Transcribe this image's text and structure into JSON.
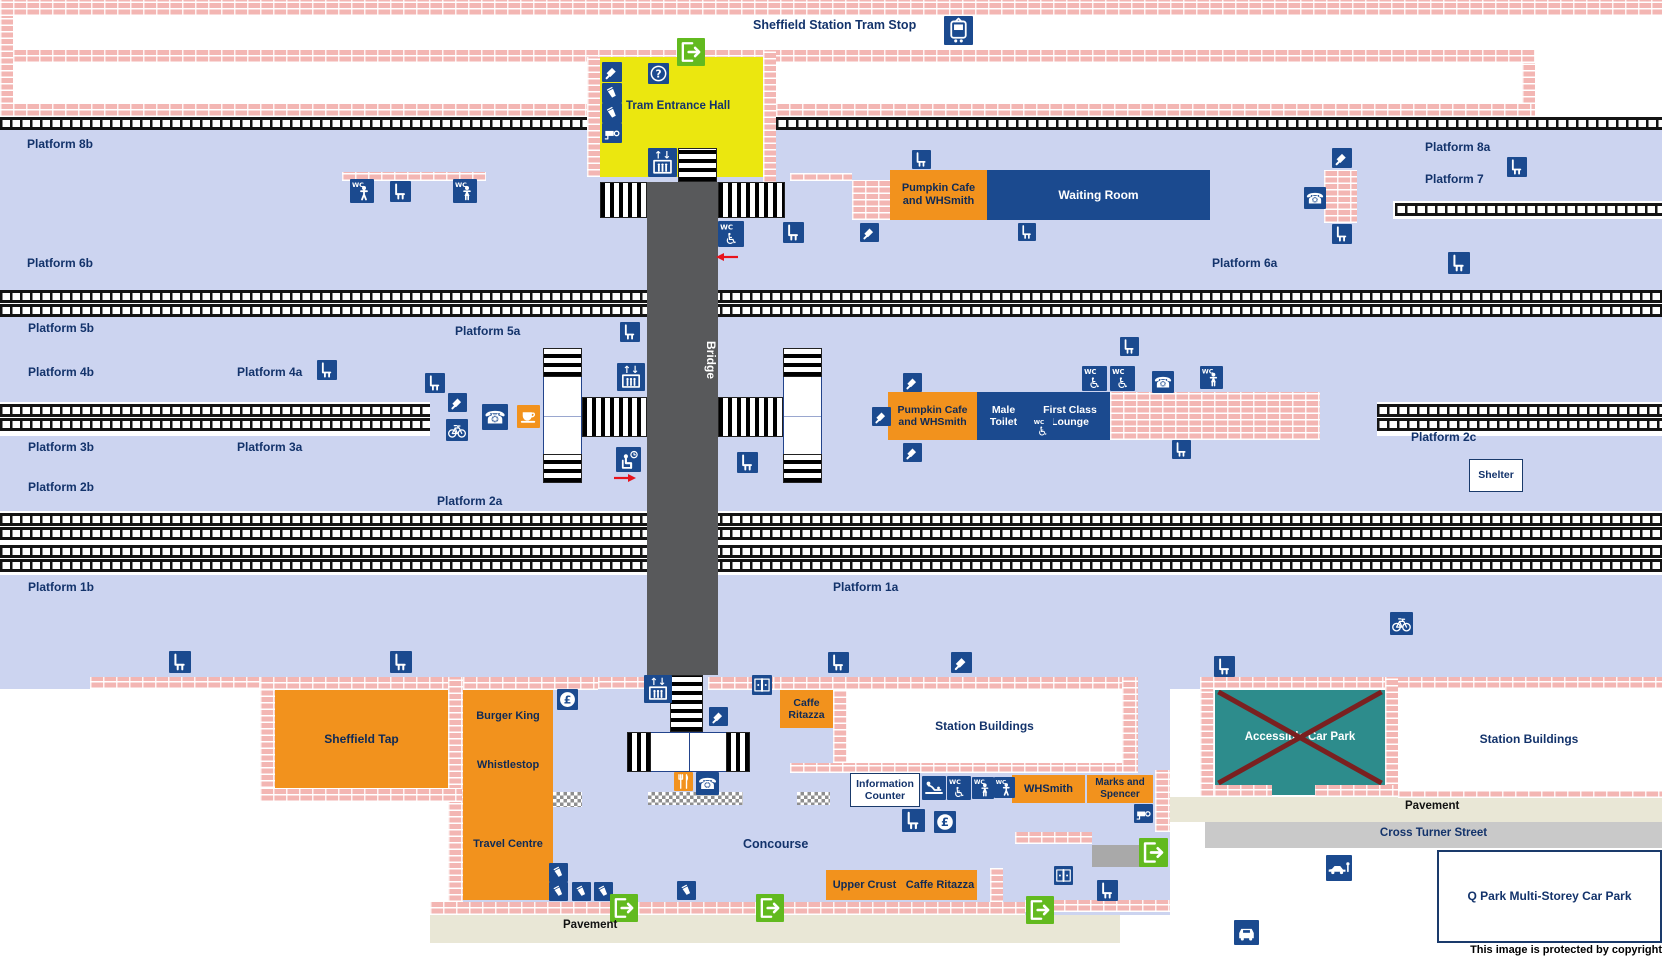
{
  "meta": {
    "width": 1662,
    "height": 962
  },
  "palette": {
    "lavender": "#ccd4f0",
    "brick": "#f3b6b3",
    "navy": "#1b4a8f",
    "label_navy": "#13336b",
    "orange": "#f2921d",
    "yellow": "#ebe70f",
    "green": "#62ba1f",
    "teal": "#2d8c8c",
    "cross_red": "#7a2020",
    "beige": "#e9e7d6",
    "street_gray": "#c9c9c9",
    "bridge_gray": "#58595b",
    "track_black": "#141414",
    "arrow_red": "#e8131c"
  },
  "regions": [
    {
      "name": "platform-band-8b-6b",
      "x": 0,
      "y": 129,
      "w": 1662,
      "h": 161,
      "cls": "lav"
    },
    {
      "name": "platform-band-5-2",
      "x": 0,
      "y": 317,
      "w": 1662,
      "h": 194,
      "cls": "lav"
    },
    {
      "name": "platform-band-1",
      "x": 0,
      "y": 575,
      "w": 1662,
      "h": 114,
      "cls": "lav"
    },
    {
      "name": "concourse-area",
      "x": 448,
      "y": 689,
      "w": 722,
      "h": 226,
      "cls": "lav"
    },
    {
      "name": "pavement-south",
      "x": 430,
      "y": 915,
      "w": 690,
      "h": 28,
      "cls": "beige"
    },
    {
      "name": "pavement-east",
      "x": 1168,
      "y": 797,
      "w": 494,
      "h": 25,
      "cls": "beige"
    },
    {
      "name": "cross-turner-street",
      "x": 1205,
      "y": 822,
      "w": 457,
      "h": 26,
      "cls": "street"
    },
    {
      "name": "taxi-area",
      "x": 1235,
      "y": 848,
      "w": 173,
      "h": 95,
      "cls": "whiteblock"
    },
    {
      "name": "corner-mark",
      "x": 0,
      "y": 0,
      "w": 10,
      "h": 10,
      "cls": "navyblock"
    },
    {
      "name": "exit-corridor",
      "x": 1092,
      "y": 845,
      "w": 48,
      "h": 22,
      "cls": "stub"
    }
  ],
  "trackbeds": [
    {
      "x": 0,
      "y": 402,
      "w": 430,
      "h": 34
    },
    {
      "x": 1377,
      "y": 402,
      "w": 285,
      "h": 34
    },
    {
      "x": 1393,
      "y": 201,
      "w": 269,
      "h": 18
    },
    {
      "x": 0,
      "y": 511,
      "w": 1662,
      "h": 63
    }
  ],
  "tracks": [
    {
      "x": 0,
      "y": 117,
      "w": 587
    },
    {
      "x": 776,
      "y": 117,
      "w": 886
    },
    {
      "x": 0,
      "y": 290,
      "w": 1662
    },
    {
      "x": 0,
      "y": 304,
      "w": 1662
    },
    {
      "x": 1395,
      "y": 203,
      "w": 267
    },
    {
      "x": 0,
      "y": 404,
      "w": 430
    },
    {
      "x": 0,
      "y": 418,
      "w": 430
    },
    {
      "x": 1377,
      "y": 404,
      "w": 285
    },
    {
      "x": 1377,
      "y": 418,
      "w": 285
    },
    {
      "x": 0,
      "y": 513,
      "w": 1662
    },
    {
      "x": 0,
      "y": 527,
      "w": 1662
    },
    {
      "x": 0,
      "y": 545,
      "w": 1662
    },
    {
      "x": 0,
      "y": 559,
      "w": 1662
    }
  ],
  "walls": [
    [
      0,
      0,
      1662,
      16
    ],
    [
      0,
      16,
      13,
      101
    ],
    [
      13,
      50,
      1522,
      13
    ],
    [
      1522,
      63,
      13,
      54
    ],
    [
      13,
      104,
      574,
      13
    ],
    [
      776,
      104,
      759,
      13
    ],
    [
      587,
      57,
      13,
      120
    ],
    [
      763,
      50,
      13,
      133
    ],
    [
      342,
      172,
      144,
      9
    ],
    [
      790,
      173,
      62,
      8
    ],
    [
      852,
      180,
      38,
      40
    ],
    [
      1324,
      170,
      33,
      53
    ],
    [
      1110,
      392,
      210,
      48
    ],
    [
      90,
      677,
      195,
      12
    ],
    [
      260,
      677,
      203,
      13
    ],
    [
      260,
      690,
      15,
      98
    ],
    [
      448,
      677,
      15,
      225
    ],
    [
      260,
      788,
      202,
      14
    ],
    [
      463,
      677,
      135,
      13
    ],
    [
      598,
      677,
      49,
      12
    ],
    [
      708,
      677,
      72,
      13
    ],
    [
      780,
      677,
      342,
      13
    ],
    [
      833,
      690,
      14,
      73
    ],
    [
      1122,
      677,
      16,
      96
    ],
    [
      790,
      763,
      332,
      10
    ],
    [
      1155,
      770,
      15,
      62
    ],
    [
      1015,
      832,
      77,
      12
    ],
    [
      1025,
      900,
      145,
      12
    ],
    [
      990,
      868,
      13,
      34
    ],
    [
      430,
      902,
      595,
      13
    ],
    [
      1200,
      677,
      462,
      12
    ],
    [
      1200,
      689,
      14,
      108
    ],
    [
      1385,
      677,
      13,
      120
    ],
    [
      1214,
      785,
      58,
      12
    ],
    [
      1314,
      785,
      84,
      12
    ],
    [
      1398,
      790,
      264,
      8
    ]
  ],
  "stairs": [
    {
      "x": 600,
      "y": 182,
      "w": 47,
      "h": 36,
      "dir": "v"
    },
    {
      "x": 718,
      "y": 182,
      "w": 67,
      "h": 36,
      "dir": "v"
    },
    {
      "x": 678,
      "y": 148,
      "w": 39,
      "h": 34,
      "dir": "h"
    },
    {
      "x": 582,
      "y": 397,
      "w": 65,
      "h": 40,
      "dir": "v"
    },
    {
      "x": 718,
      "y": 397,
      "w": 65,
      "h": 40,
      "dir": "v"
    },
    {
      "x": 670,
      "y": 675,
      "w": 33,
      "h": 57,
      "dir": "h"
    }
  ],
  "towers": [
    {
      "name": "stair-tower-west",
      "x": 543,
      "y": 348,
      "w": 39,
      "h": 135
    },
    {
      "name": "stair-tower-east",
      "x": 783,
      "y": 348,
      "w": 39,
      "h": 135
    }
  ],
  "hbars": [
    {
      "name": "concourse-stairs",
      "x": 627,
      "y": 732,
      "w": 123,
      "h": 40
    }
  ],
  "checkers": [
    [
      553,
      792,
      29,
      15
    ],
    [
      648,
      792,
      95,
      13
    ],
    [
      797,
      792,
      33,
      13
    ]
  ],
  "bridge": {
    "label": "Bridge",
    "x": 647,
    "y": 182,
    "w": 71,
    "h": 493
  },
  "hall": {
    "label": "Tram Entrance Hall",
    "x": 600,
    "y": 57,
    "w": 163,
    "h": 120,
    "bg": "#ebe70f"
  },
  "buildings": [
    {
      "name": "pumpkin-cafe-north",
      "label": "Pumpkin Cafe\nand WHSmith",
      "x": 890,
      "y": 170,
      "w": 97,
      "h": 50,
      "cls": "orange",
      "fs": 11
    },
    {
      "name": "waiting-room",
      "label": "Waiting Room",
      "x": 987,
      "y": 170,
      "w": 223,
      "h": 50,
      "cls": "navy",
      "fs": 12
    },
    {
      "name": "pumpkin-cafe-mid",
      "label": "Pumpkin Cafe\nand WHSmith",
      "x": 888,
      "y": 392,
      "w": 89,
      "h": 48,
      "cls": "orange",
      "fs": 10.5
    },
    {
      "name": "male-toilet",
      "label": "Male\nToilet",
      "x": 977,
      "y": 392,
      "w": 53,
      "h": 48,
      "cls": "navy",
      "fs": 10.5
    },
    {
      "name": "first-class-lounge",
      "label": "First Class\nLounge",
      "x": 1030,
      "y": 392,
      "w": 80,
      "h": 48,
      "cls": "navy",
      "fs": 10.5
    },
    {
      "name": "shelter",
      "label": "Shelter",
      "x": 1469,
      "y": 459,
      "w": 54,
      "h": 33,
      "cls": "outline",
      "fs": 10.5
    },
    {
      "name": "sheffield-tap",
      "label": "Sheffield Tap",
      "x": 275,
      "y": 690,
      "w": 173,
      "h": 98,
      "cls": "orange",
      "fs": 12
    },
    {
      "name": "burger-king",
      "label": "Burger King",
      "x": 463,
      "y": 690,
      "w": 90,
      "h": 52,
      "cls": "orange",
      "fs": 11
    },
    {
      "name": "whistlestop",
      "label": "Whistlestop",
      "x": 463,
      "y": 742,
      "w": 90,
      "h": 46,
      "cls": "orange",
      "fs": 11
    },
    {
      "name": "travel-centre",
      "label": "Travel Centre",
      "x": 463,
      "y": 788,
      "w": 90,
      "h": 112,
      "cls": "orange",
      "fs": 11
    },
    {
      "name": "caffe-ritazza-north",
      "label": "Caffe\nRitazza",
      "x": 780,
      "y": 690,
      "w": 53,
      "h": 38,
      "cls": "orange",
      "fs": 10.5
    },
    {
      "name": "station-buildings-west",
      "label": "Station Buildings",
      "x": 847,
      "y": 690,
      "w": 275,
      "h": 73,
      "cls": "white",
      "fs": 12
    },
    {
      "name": "information-counter",
      "label": "Information\nCounter",
      "x": 850,
      "y": 773,
      "w": 70,
      "h": 34,
      "cls": "outline",
      "fs": 10.5
    },
    {
      "name": "whsmith",
      "label": "WHSmith",
      "x": 1012,
      "y": 775,
      "w": 73,
      "h": 28,
      "cls": "orange",
      "fs": 11
    },
    {
      "name": "marks-and-spencer",
      "label": "Marks and\nSpencer",
      "x": 1087,
      "y": 775,
      "w": 66,
      "h": 28,
      "cls": "orange",
      "fs": 10
    },
    {
      "name": "upper-crust",
      "label": "Upper Crust",
      "x": 826,
      "y": 870,
      "w": 77,
      "h": 30,
      "cls": "orange",
      "fs": 11
    },
    {
      "name": "caffe-ritazza-south",
      "label": "Caffe Ritazza",
      "x": 903,
      "y": 870,
      "w": 74,
      "h": 30,
      "cls": "orange",
      "fs": 11
    },
    {
      "name": "accessible-car-park",
      "label": "Accessible Car Park",
      "x": 1215,
      "y": 690,
      "w": 170,
      "h": 95,
      "cls": "teal",
      "fs": 11.5,
      "cross": true
    },
    {
      "name": "accessible-car-park-notch",
      "label": "",
      "x": 1272,
      "y": 785,
      "w": 43,
      "h": 10,
      "cls": "teal",
      "fs": 0
    },
    {
      "name": "station-buildings-east",
      "label": "Station Buildings",
      "x": 1398,
      "y": 689,
      "w": 262,
      "h": 101,
      "cls": "white",
      "fs": 12
    },
    {
      "name": "q-park",
      "label": "Q Park Multi-Storey Car Park",
      "x": 1437,
      "y": 850,
      "w": 225,
      "h": 93,
      "cls": "outline2",
      "fs": 12
    }
  ],
  "labels": [
    {
      "t": "Sheffield Station Tram Stop",
      "x": 753,
      "y": 18,
      "fs": 12.5
    },
    {
      "t": "Platform 8b",
      "x": 27,
      "y": 137
    },
    {
      "t": "Platform 6b",
      "x": 27,
      "y": 256
    },
    {
      "t": "Platform 8a",
      "x": 1425,
      "y": 140
    },
    {
      "t": "Platform 7",
      "x": 1425,
      "y": 172
    },
    {
      "t": "Platform 6a",
      "x": 1212,
      "y": 256
    },
    {
      "t": "Platform 5b",
      "x": 28,
      "y": 321
    },
    {
      "t": "Platform 5a",
      "x": 455,
      "y": 324
    },
    {
      "t": "Platform 4b",
      "x": 28,
      "y": 365
    },
    {
      "t": "Platform 4a",
      "x": 237,
      "y": 365
    },
    {
      "t": "Platform 3b",
      "x": 28,
      "y": 440
    },
    {
      "t": "Platform 3a",
      "x": 237,
      "y": 440
    },
    {
      "t": "Platform 2b",
      "x": 28,
      "y": 480
    },
    {
      "t": "Platform 2a",
      "x": 437,
      "y": 494
    },
    {
      "t": "Platform 2c",
      "x": 1411,
      "y": 430
    },
    {
      "t": "Platform 1b",
      "x": 28,
      "y": 580
    },
    {
      "t": "Platform 1a",
      "x": 833,
      "y": 580
    },
    {
      "t": "Concourse",
      "x": 743,
      "y": 837,
      "fs": 12.5
    },
    {
      "t": "Pavement",
      "x": 563,
      "y": 919,
      "fs": 11.5,
      "c": "#111"
    },
    {
      "t": "Pavement",
      "x": 1405,
      "y": 800,
      "fs": 11.5,
      "c": "#111"
    },
    {
      "t": "Cross Turner Street",
      "x": 1205,
      "y": 827,
      "w": 457,
      "al": "c",
      "fs": 11.5
    },
    {
      "t": "This image is protected by copyright",
      "x": 1270,
      "y": 944,
      "w": 392,
      "al": "r",
      "fs": 11,
      "c": "#000"
    }
  ],
  "hall_icons_note": "icon column inside tram entrance hall: ticket machine, vending, vending, cctv",
  "icons": [
    [
      "tram",
      944,
      16,
      29
    ],
    [
      "exit",
      677,
      38,
      28
    ],
    [
      "help",
      648,
      63,
      21
    ],
    [
      "ticketMachine",
      602,
      62,
      20
    ],
    [
      "vending",
      602,
      83,
      20
    ],
    [
      "vending",
      602,
      103,
      20
    ],
    [
      "cctv",
      602,
      123,
      20
    ],
    [
      "lift",
      648,
      148,
      29
    ],
    [
      "wcMale",
      350,
      179,
      24
    ],
    [
      "seat",
      390,
      181,
      21
    ],
    [
      "wcFemale",
      453,
      179,
      24
    ],
    [
      "seat",
      912,
      150,
      19
    ],
    [
      "seat",
      783,
      222,
      21
    ],
    [
      "wcAccessible",
      718,
      221,
      26
    ],
    [
      "ticketMachine",
      860,
      223,
      19
    ],
    [
      "seat",
      1018,
      223,
      18
    ],
    [
      "ticketMachine",
      1332,
      148,
      20
    ],
    [
      "phone",
      1304,
      187,
      22
    ],
    [
      "seat",
      1332,
      224,
      20
    ],
    [
      "seat",
      1507,
      157,
      20
    ],
    [
      "seat",
      1448,
      252,
      22
    ],
    [
      "seat",
      620,
      322,
      20
    ],
    [
      "seat",
      317,
      360,
      20
    ],
    [
      "seat",
      425,
      373,
      20
    ],
    [
      "ticketMachine",
      448,
      393,
      19
    ],
    [
      "bicycle",
      446,
      419,
      22
    ],
    [
      "lift",
      617,
      363,
      28
    ],
    [
      "phone",
      482,
      404,
      26
    ],
    [
      "cafe",
      517,
      405,
      23
    ],
    [
      "waitingPoint",
      616,
      447,
      25
    ],
    [
      "seat",
      737,
      452,
      21
    ],
    [
      "seat",
      1120,
      337,
      19
    ],
    [
      "ticketMachine",
      903,
      373,
      19
    ],
    [
      "ticketMachine",
      872,
      407,
      19
    ],
    [
      "ticketMachine",
      903,
      443,
      19
    ],
    [
      "wcAccessible",
      1082,
      366,
      25
    ],
    [
      "wcAccessible",
      1110,
      366,
      25
    ],
    [
      "phone",
      1152,
      371,
      22
    ],
    [
      "wcFemale",
      1200,
      366,
      23
    ],
    [
      "wcAccessible",
      1032,
      417,
      21
    ],
    [
      "seat",
      1172,
      440,
      19
    ],
    [
      "bicycle",
      1390,
      612,
      23
    ],
    [
      "seat",
      169,
      651,
      22
    ],
    [
      "seat",
      390,
      651,
      22
    ],
    [
      "seat",
      828,
      652,
      21
    ],
    [
      "ticketMachine",
      951,
      652,
      21
    ],
    [
      "seat",
      1214,
      656,
      21
    ],
    [
      "lift",
      644,
      675,
      28
    ],
    [
      "gates",
      752,
      675,
      20
    ],
    [
      "ticketMachine",
      709,
      707,
      19
    ],
    [
      "restaurant",
      674,
      772,
      19
    ],
    [
      "phone",
      696,
      772,
      23
    ],
    [
      "currency",
      557,
      689,
      21
    ],
    [
      "babyChange",
      922,
      776,
      24
    ],
    [
      "wcAccessible",
      947,
      776,
      24
    ],
    [
      "wcFemale",
      972,
      777,
      22
    ],
    [
      "wcMale",
      994,
      777,
      21
    ],
    [
      "seat",
      902,
      809,
      23
    ],
    [
      "currency",
      934,
      811,
      22
    ],
    [
      "cctv",
      1134,
      804,
      19
    ],
    [
      "vending",
      549,
      863,
      19
    ],
    [
      "vending",
      549,
      882,
      19
    ],
    [
      "vending",
      572,
      882,
      19
    ],
    [
      "vending",
      594,
      882,
      19
    ],
    [
      "vending",
      677,
      881,
      19
    ],
    [
      "exit",
      610,
      894,
      28
    ],
    [
      "exit",
      756,
      894,
      28
    ],
    [
      "exit",
      1026,
      896,
      28
    ],
    [
      "exit",
      1139,
      838,
      29
    ],
    [
      "gates",
      1054,
      866,
      19
    ],
    [
      "seat",
      1097,
      880,
      21
    ],
    [
      "dropOff",
      1326,
      855,
      26
    ],
    [
      "taxi",
      1234,
      920,
      25
    ]
  ],
  "arrows": [
    {
      "dir": "left",
      "x": 714,
      "y": 249
    },
    {
      "dir": "right",
      "x": 612,
      "y": 470
    }
  ]
}
